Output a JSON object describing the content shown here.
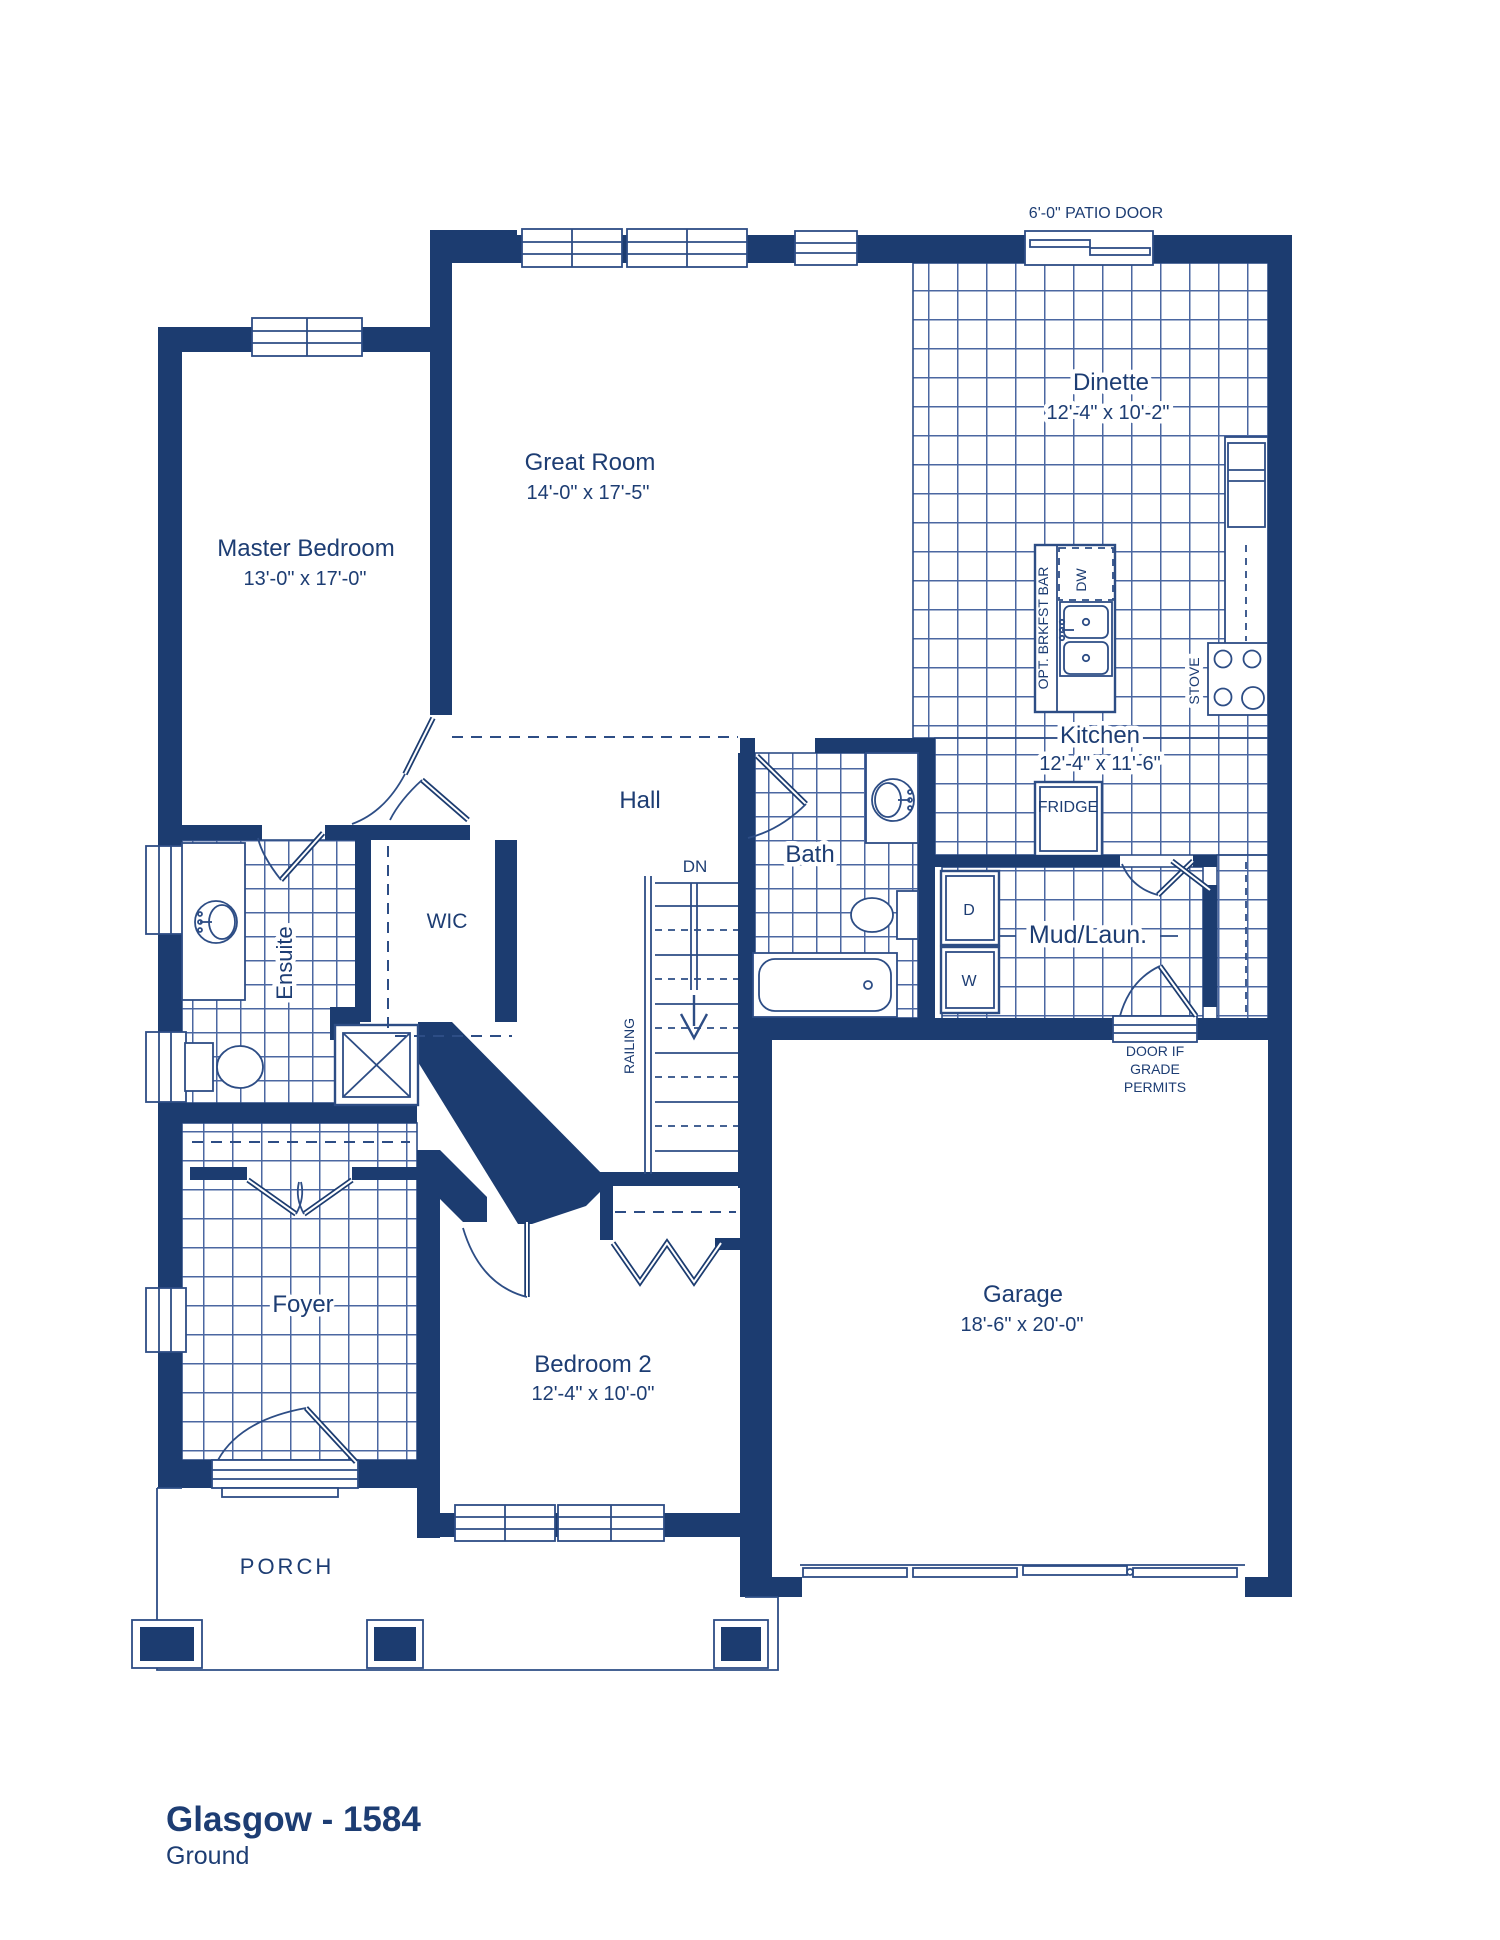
{
  "page": {
    "title_model": "Glasgow - 1584",
    "title_floor": "Ground"
  },
  "rooms": {
    "master": {
      "label": "Master Bedroom",
      "dims": "13'-0\" x 17'-0\""
    },
    "great": {
      "label": "Great Room",
      "dims": "14'-0\" x 17'-5\""
    },
    "dinette": {
      "label": "Dinette",
      "dims": "12'-4\" x 10'-2\""
    },
    "kitchen": {
      "label": "Kitchen",
      "dims": "12'-4\" x 11'-6\""
    },
    "bath": {
      "label": "Bath"
    },
    "hall": {
      "label": "Hall"
    },
    "wic": {
      "label": "WIC"
    },
    "ensuite": {
      "label": "Ensuite"
    },
    "mud": {
      "label": "Mud/Laun."
    },
    "foyer": {
      "label": "Foyer"
    },
    "bedroom2": {
      "label": "Bedroom 2",
      "dims": "12'-4\" x 10'-0\""
    },
    "garage": {
      "label": "Garage",
      "dims": "18'-6\" x 20'-0\""
    },
    "porch": {
      "label": "PORCH"
    }
  },
  "fixtures": {
    "dishwasher": "DW",
    "breakfast_bar": "OPT. BRKFST BAR",
    "stove": "STOVE",
    "fridge": "FRIDGE",
    "dryer": "D",
    "washer": "W"
  },
  "stairs": {
    "down": "DN",
    "railing": "RAILING"
  },
  "notes": {
    "patio_door": "6'-0\" PATIO DOOR",
    "grade_door_line1": "DOOR IF",
    "grade_door_line2": "GRADE",
    "grade_door_line3": "PERMITS"
  },
  "colors": {
    "navy": "#1c3c70",
    "line": "#2d4d85",
    "tile": "#4b67a1",
    "text": "#1d3d73"
  }
}
